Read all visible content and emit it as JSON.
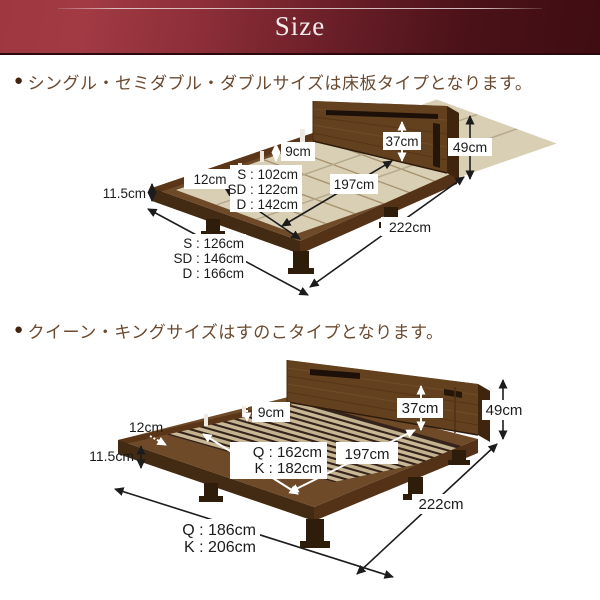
{
  "header": {
    "title": "Size"
  },
  "sections": [
    {
      "bullet": "●",
      "heading": "シングル・セミダブル・ダブルサイズは床板タイプとなります。",
      "type_note": "床板タイプ",
      "dims": {
        "platform_height": "11.5cm",
        "stage_margin": "12cm",
        "frame_height": "9cm",
        "headboard_height": "37cm",
        "total_height": "49cm",
        "inner_length": "197cm",
        "total_length": "222cm",
        "inner_width": [
          "S : 102cm",
          "SD : 122cm",
          "D : 142cm"
        ],
        "outer_width": [
          "S : 126cm",
          "SD : 146cm",
          "D : 166cm"
        ]
      }
    },
    {
      "bullet": "●",
      "heading": "クイーン・キングサイズはすのこタイプとなります。",
      "type_note": "すのこタイプ",
      "dims": {
        "platform_height": "11.5cm",
        "stage_margin": "12cm",
        "frame_height": "9cm",
        "headboard_height": "37cm",
        "total_height": "49cm",
        "inner_length": "197cm",
        "total_length": "222cm",
        "inner_width": [
          "Q : 162cm",
          "K : 182cm"
        ],
        "outer_width": [
          "Q : 186cm",
          "K : 206cm"
        ]
      }
    }
  ],
  "colors": {
    "header_left": "#a03a44",
    "header_right": "#3f0d12",
    "wood_top": "#6f4a28",
    "wood_side": "#432a12",
    "floor_board": "#d9cfb4",
    "slat": "#c9b795",
    "heading_text": "#6a4a30"
  }
}
